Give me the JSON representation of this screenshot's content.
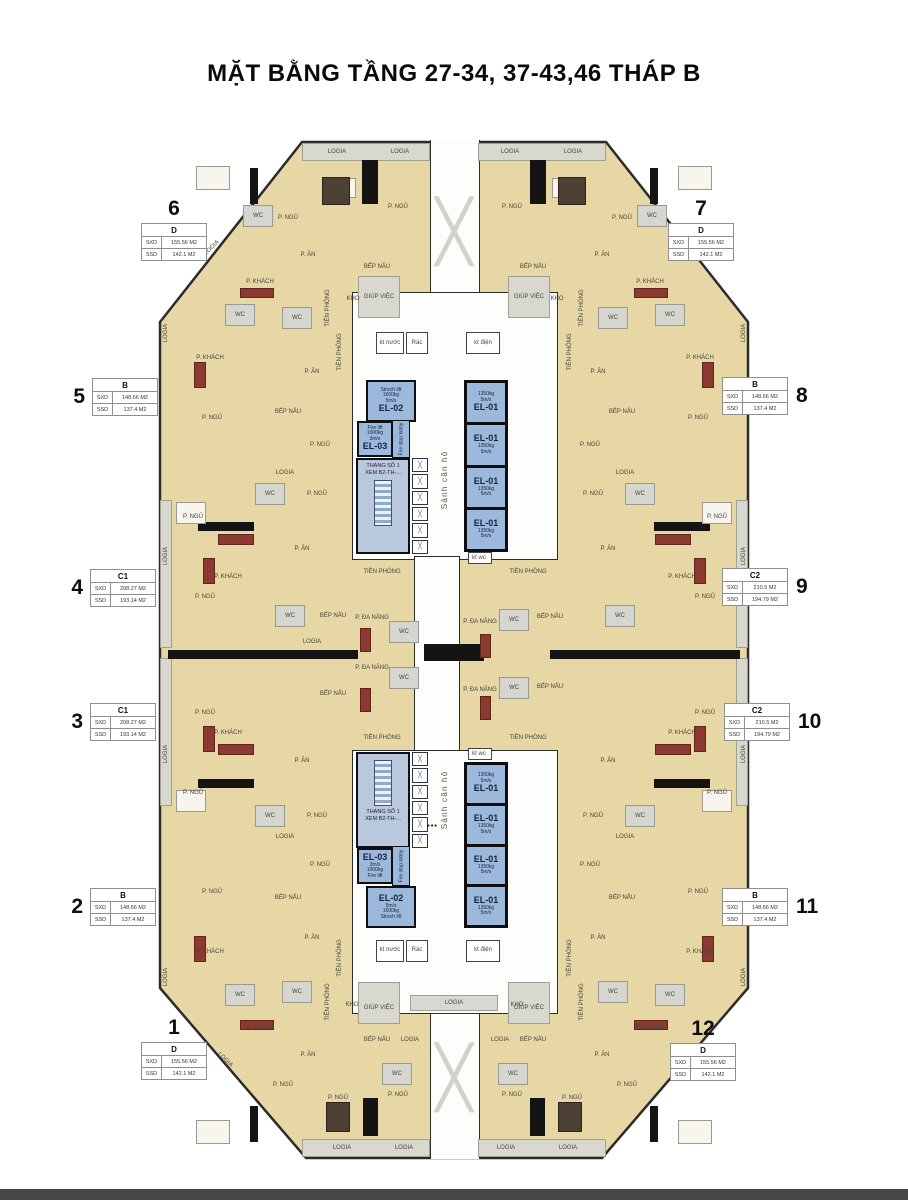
{
  "title": "MẶT BẰNG TẦNG 27-34, 37-43,46 THÁP B",
  "legend": {
    "sxd": "SXD",
    "ssd": "SSD"
  },
  "glyphs": {
    "brace": "╳",
    "dots": "..."
  },
  "core": {
    "corridor_label": "Sảnh căn hộ",
    "stair": {
      "line1": "THANG SỐ 1",
      "line2": "XEM B2-TH-..."
    },
    "fire_lobby": "Fire stop lobby",
    "el01": {
      "name": "EL-01",
      "cap": "1350kg",
      "spd": "5m/s"
    },
    "el02": {
      "name": "EL-02",
      "kind": "Strech lift",
      "cap": "1600kg",
      "spd": "5m/s"
    },
    "el03": {
      "name": "EL-03",
      "kind": "Fire lift",
      "cap": "1000kg",
      "spd": "3m/s"
    }
  },
  "units": [
    {
      "no": "1",
      "type": "D",
      "sxd": "155.56 M2",
      "ssd": "142.1  M2",
      "x": 141,
      "y": 1042,
      "num": "top"
    },
    {
      "no": "2",
      "type": "B",
      "sxd": "148.66 M2",
      "ssd": "137.4  M2",
      "x": 90,
      "y": 888,
      "num": "left"
    },
    {
      "no": "3",
      "type": "C1",
      "sxd": "208.27 M2",
      "ssd": "193.14 M2",
      "x": 90,
      "y": 703,
      "num": "left"
    },
    {
      "no": "4",
      "type": "C1",
      "sxd": "208.27 M2",
      "ssd": "193.14 M2",
      "x": 90,
      "y": 569,
      "num": "left"
    },
    {
      "no": "5",
      "type": "B",
      "sxd": "148.66 M2",
      "ssd": "137.4  M2",
      "x": 92,
      "y": 378,
      "num": "left"
    },
    {
      "no": "6",
      "type": "D",
      "sxd": "155.56 M2",
      "ssd": "142.1  M2",
      "x": 141,
      "y": 223,
      "num": "top"
    },
    {
      "no": "7",
      "type": "D",
      "sxd": "155.56 M2",
      "ssd": "142.1  M2",
      "x": 668,
      "y": 223,
      "num": "top"
    },
    {
      "no": "8",
      "type": "B",
      "sxd": "148.66 M2",
      "ssd": "137.4  M2",
      "x": 722,
      "y": 377,
      "num": "right"
    },
    {
      "no": "9",
      "type": "C2",
      "sxd": "210.5  M2",
      "ssd": "194.79 M2",
      "x": 722,
      "y": 568,
      "num": "right"
    },
    {
      "no": "10",
      "type": "C2",
      "sxd": "210.5  M2",
      "ssd": "194.79 M2",
      "x": 724,
      "y": 703,
      "num": "right"
    },
    {
      "no": "11",
      "type": "B",
      "sxd": "148.66 M2",
      "ssd": "137.4  M2",
      "x": 722,
      "y": 888,
      "num": "right"
    },
    {
      "no": "12",
      "type": "D",
      "sxd": "155.56 M2",
      "ssd": "142.1  M2",
      "x": 670,
      "y": 1043,
      "num": "top"
    }
  ],
  "room_labels": [
    {
      "t": "LOGIA",
      "x": 337,
      "y": 152
    },
    {
      "t": "LOGIA",
      "x": 400,
      "y": 152
    },
    {
      "t": "LOGIA",
      "x": 510,
      "y": 152
    },
    {
      "t": "LOGIA",
      "x": 573,
      "y": 152
    },
    {
      "t": "P. NGỦ",
      "x": 288,
      "y": 218
    },
    {
      "t": "P. NGỦ",
      "x": 398,
      "y": 207
    },
    {
      "t": "WC",
      "x": 258,
      "y": 216
    },
    {
      "t": "P. ĂN",
      "x": 308,
      "y": 255
    },
    {
      "t": "P. KHÁCH",
      "x": 260,
      "y": 282
    },
    {
      "t": "BẾP NẤU",
      "x": 377,
      "y": 267
    },
    {
      "t": "KHO",
      "x": 353,
      "y": 299
    },
    {
      "t": "GIÚP VIỆC",
      "x": 379,
      "y": 297
    },
    {
      "t": "TIỀN PHÒNG",
      "x": 328,
      "y": 308,
      "r": -90
    },
    {
      "t": "WC",
      "x": 297,
      "y": 318
    },
    {
      "t": "P. NGỦ",
      "x": 622,
      "y": 218
    },
    {
      "t": "P. NGỦ",
      "x": 512,
      "y": 207
    },
    {
      "t": "WC",
      "x": 652,
      "y": 216
    },
    {
      "t": "P. ĂN",
      "x": 602,
      "y": 255
    },
    {
      "t": "P. KHÁCH",
      "x": 650,
      "y": 282
    },
    {
      "t": "BẾP NẤU",
      "x": 533,
      "y": 267
    },
    {
      "t": "KHO",
      "x": 557,
      "y": 299
    },
    {
      "t": "GIÚP VIỆC",
      "x": 529,
      "y": 297
    },
    {
      "t": "TIỀN PHÒNG",
      "x": 582,
      "y": 308,
      "r": -90
    },
    {
      "t": "WC",
      "x": 613,
      "y": 318
    },
    {
      "t": "kt nước",
      "x": 390,
      "y": 343
    },
    {
      "t": "Rác",
      "x": 417,
      "y": 343
    },
    {
      "t": "kt điện",
      "x": 483,
      "y": 343
    },
    {
      "t": "P. KHÁCH",
      "x": 210,
      "y": 358
    },
    {
      "t": "P. ĂN",
      "x": 312,
      "y": 372
    },
    {
      "t": "BẾP NẤU",
      "x": 288,
      "y": 412
    },
    {
      "t": "P. NGỦ",
      "x": 212,
      "y": 418
    },
    {
      "t": "WC",
      "x": 240,
      "y": 315
    },
    {
      "t": "P. NGỦ",
      "x": 320,
      "y": 445
    },
    {
      "t": "TIỀN PHÒNG",
      "x": 340,
      "y": 352,
      "r": -90
    },
    {
      "t": "LOGIA",
      "x": 166,
      "y": 333,
      "r": -90
    },
    {
      "t": "P. KHÁCH",
      "x": 700,
      "y": 358
    },
    {
      "t": "P. ĂN",
      "x": 598,
      "y": 372
    },
    {
      "t": "BẾP NẤU",
      "x": 622,
      "y": 412
    },
    {
      "t": "P. NGỦ",
      "x": 698,
      "y": 418
    },
    {
      "t": "WC",
      "x": 670,
      "y": 315
    },
    {
      "t": "P. NGỦ",
      "x": 590,
      "y": 445
    },
    {
      "t": "TIỀN PHÒNG",
      "x": 570,
      "y": 352,
      "r": -90
    },
    {
      "t": "LOGIA",
      "x": 744,
      "y": 333,
      "r": -90
    },
    {
      "t": "LOGIA",
      "x": 285,
      "y": 473
    },
    {
      "t": "P. NGỦ",
      "x": 193,
      "y": 517
    },
    {
      "t": "P. NGỦ",
      "x": 317,
      "y": 494
    },
    {
      "t": "WC",
      "x": 270,
      "y": 494
    },
    {
      "t": "P. ĂN",
      "x": 302,
      "y": 549
    },
    {
      "t": "P. KHÁCH",
      "x": 228,
      "y": 577
    },
    {
      "t": "LOGIA",
      "x": 166,
      "y": 556,
      "r": -90
    },
    {
      "t": "P. NGỦ",
      "x": 205,
      "y": 597
    },
    {
      "t": "WC",
      "x": 290,
      "y": 616
    },
    {
      "t": "BẾP NẤU",
      "x": 333,
      "y": 616
    },
    {
      "t": "LOGIA",
      "x": 312,
      "y": 642
    },
    {
      "t": "P. ĐA NĂNG",
      "x": 372,
      "y": 618
    },
    {
      "t": "WC",
      "x": 404,
      "y": 632
    },
    {
      "t": "TIỀN PHÒNG",
      "x": 382,
      "y": 572
    },
    {
      "t": "P. ĐA NĂNG",
      "x": 372,
      "y": 668
    },
    {
      "t": "WC",
      "x": 404,
      "y": 678
    },
    {
      "t": "P. NGỦ",
      "x": 205,
      "y": 713
    },
    {
      "t": "P. KHÁCH",
      "x": 228,
      "y": 733
    },
    {
      "t": "P. ĂN",
      "x": 302,
      "y": 761
    },
    {
      "t": "P. NGỦ",
      "x": 193,
      "y": 793
    },
    {
      "t": "P. NGỦ",
      "x": 317,
      "y": 816
    },
    {
      "t": "WC",
      "x": 270,
      "y": 816
    },
    {
      "t": "BẾP NẤU",
      "x": 333,
      "y": 694
    },
    {
      "t": "LOGIA",
      "x": 285,
      "y": 837
    },
    {
      "t": "LOGIA",
      "x": 166,
      "y": 754,
      "r": -90
    },
    {
      "t": "TIỀN PHÒNG",
      "x": 382,
      "y": 738
    },
    {
      "t": "LOGIA",
      "x": 625,
      "y": 473
    },
    {
      "t": "P. NGỦ",
      "x": 717,
      "y": 517
    },
    {
      "t": "P. NGỦ",
      "x": 593,
      "y": 494
    },
    {
      "t": "WC",
      "x": 640,
      "y": 494
    },
    {
      "t": "P. ĂN",
      "x": 608,
      "y": 549
    },
    {
      "t": "P. KHÁCH",
      "x": 682,
      "y": 577
    },
    {
      "t": "LOGIA",
      "x": 744,
      "y": 556,
      "r": -90
    },
    {
      "t": "P. NGỦ",
      "x": 705,
      "y": 597
    },
    {
      "t": "WC",
      "x": 620,
      "y": 616
    },
    {
      "t": "BẾP NẤU",
      "x": 550,
      "y": 617
    },
    {
      "t": "P. ĐA NĂNG",
      "x": 480,
      "y": 622
    },
    {
      "t": "WC",
      "x": 514,
      "y": 620
    },
    {
      "t": "TIỀN PHÒNG",
      "x": 528,
      "y": 572
    },
    {
      "t": "P. ĐA NĂNG",
      "x": 480,
      "y": 690
    },
    {
      "t": "WC",
      "x": 514,
      "y": 688
    },
    {
      "t": "BẾP NẤU",
      "x": 550,
      "y": 687
    },
    {
      "t": "P. NGỦ",
      "x": 705,
      "y": 713
    },
    {
      "t": "P. KHÁCH",
      "x": 682,
      "y": 733
    },
    {
      "t": "P. ĂN",
      "x": 608,
      "y": 761
    },
    {
      "t": "P. NGỦ",
      "x": 717,
      "y": 793
    },
    {
      "t": "P. NGỦ",
      "x": 593,
      "y": 816
    },
    {
      "t": "WC",
      "x": 640,
      "y": 816
    },
    {
      "t": "LOGIA",
      "x": 625,
      "y": 837
    },
    {
      "t": "LOGIA",
      "x": 744,
      "y": 754,
      "r": -90
    },
    {
      "t": "TIỀN PHÒNG",
      "x": 528,
      "y": 738
    },
    {
      "t": "P. NGỦ",
      "x": 212,
      "y": 892
    },
    {
      "t": "BẾP NẤU",
      "x": 288,
      "y": 898
    },
    {
      "t": "P. ĂN",
      "x": 312,
      "y": 938
    },
    {
      "t": "P. KHÁCH",
      "x": 210,
      "y": 952
    },
    {
      "t": "WC",
      "x": 240,
      "y": 995
    },
    {
      "t": "P. NGỦ",
      "x": 320,
      "y": 865
    },
    {
      "t": "TIỀN PHÒNG",
      "x": 340,
      "y": 958,
      "r": -90
    },
    {
      "t": "LOGIA",
      "x": 166,
      "y": 977,
      "r": -90
    },
    {
      "t": "P. NGỦ",
      "x": 698,
      "y": 892
    },
    {
      "t": "BẾP NẤU",
      "x": 622,
      "y": 898
    },
    {
      "t": "P. ĂN",
      "x": 598,
      "y": 938
    },
    {
      "t": "P. KHÁCH",
      "x": 700,
      "y": 952
    },
    {
      "t": "WC",
      "x": 670,
      "y": 995
    },
    {
      "t": "P. NGỦ",
      "x": 590,
      "y": 865
    },
    {
      "t": "TIỀN PHÒNG",
      "x": 570,
      "y": 958,
      "r": -90
    },
    {
      "t": "LOGIA",
      "x": 744,
      "y": 977,
      "r": -90
    },
    {
      "t": "kt nước",
      "x": 390,
      "y": 950
    },
    {
      "t": "Rác",
      "x": 417,
      "y": 950
    },
    {
      "t": "kt điện",
      "x": 483,
      "y": 950
    },
    {
      "t": "KHO",
      "x": 352,
      "y": 1005
    },
    {
      "t": "GIÚP VIỆC",
      "x": 379,
      "y": 1008
    },
    {
      "t": "BẾP NẤU",
      "x": 377,
      "y": 1040
    },
    {
      "t": "LOGIA",
      "x": 410,
      "y": 1040
    },
    {
      "t": "TIỀN PHÒNG",
      "x": 328,
      "y": 1002,
      "r": -90
    },
    {
      "t": "WC",
      "x": 297,
      "y": 992
    },
    {
      "t": "P. KHÁCH",
      "x": 260,
      "y": 1028
    },
    {
      "t": "P. ĂN",
      "x": 308,
      "y": 1055
    },
    {
      "t": "P. NGỦ",
      "x": 283,
      "y": 1085
    },
    {
      "t": "P. NGỦ",
      "x": 338,
      "y": 1098
    },
    {
      "t": "P. NGỦ",
      "x": 398,
      "y": 1095
    },
    {
      "t": "WC",
      "x": 397,
      "y": 1074
    },
    {
      "t": "LOGIA",
      "x": 342,
      "y": 1148
    },
    {
      "t": "LOGIA",
      "x": 404,
      "y": 1148
    },
    {
      "t": "KHO",
      "x": 517,
      "y": 1005
    },
    {
      "t": "GIÚP VIỆC",
      "x": 529,
      "y": 1008
    },
    {
      "t": "BẾP NẤU",
      "x": 533,
      "y": 1040
    },
    {
      "t": "LOGIA",
      "x": 500,
      "y": 1040
    },
    {
      "t": "TIỀN PHÒNG",
      "x": 582,
      "y": 1002,
      "r": -90
    },
    {
      "t": "WC",
      "x": 613,
      "y": 992
    },
    {
      "t": "P. KHÁCH",
      "x": 650,
      "y": 1028
    },
    {
      "t": "P. ĂN",
      "x": 602,
      "y": 1055
    },
    {
      "t": "P. NGỦ",
      "x": 627,
      "y": 1085
    },
    {
      "t": "P. NGỦ",
      "x": 572,
      "y": 1098
    },
    {
      "t": "P. NGỦ",
      "x": 512,
      "y": 1095
    },
    {
      "t": "WC",
      "x": 513,
      "y": 1074
    },
    {
      "t": "LOGIA",
      "x": 568,
      "y": 1148
    },
    {
      "t": "LOGIA",
      "x": 506,
      "y": 1148
    },
    {
      "t": "LOGIA",
      "x": 454,
      "y": 1003
    },
    {
      "t": "kt wc",
      "x": 479,
      "y": 558
    },
    {
      "t": "kt wc",
      "x": 479,
      "y": 754
    },
    {
      "t": "LOGIA",
      "x": 212,
      "y": 248,
      "r": -45
    },
    {
      "t": "LOGIA",
      "x": 696,
      "y": 248,
      "r": 45
    },
    {
      "t": "LOGIA",
      "x": 225,
      "y": 1060,
      "r": 45
    },
    {
      "t": "LOGIA",
      "x": 683,
      "y": 1060,
      "r": -45
    }
  ]
}
